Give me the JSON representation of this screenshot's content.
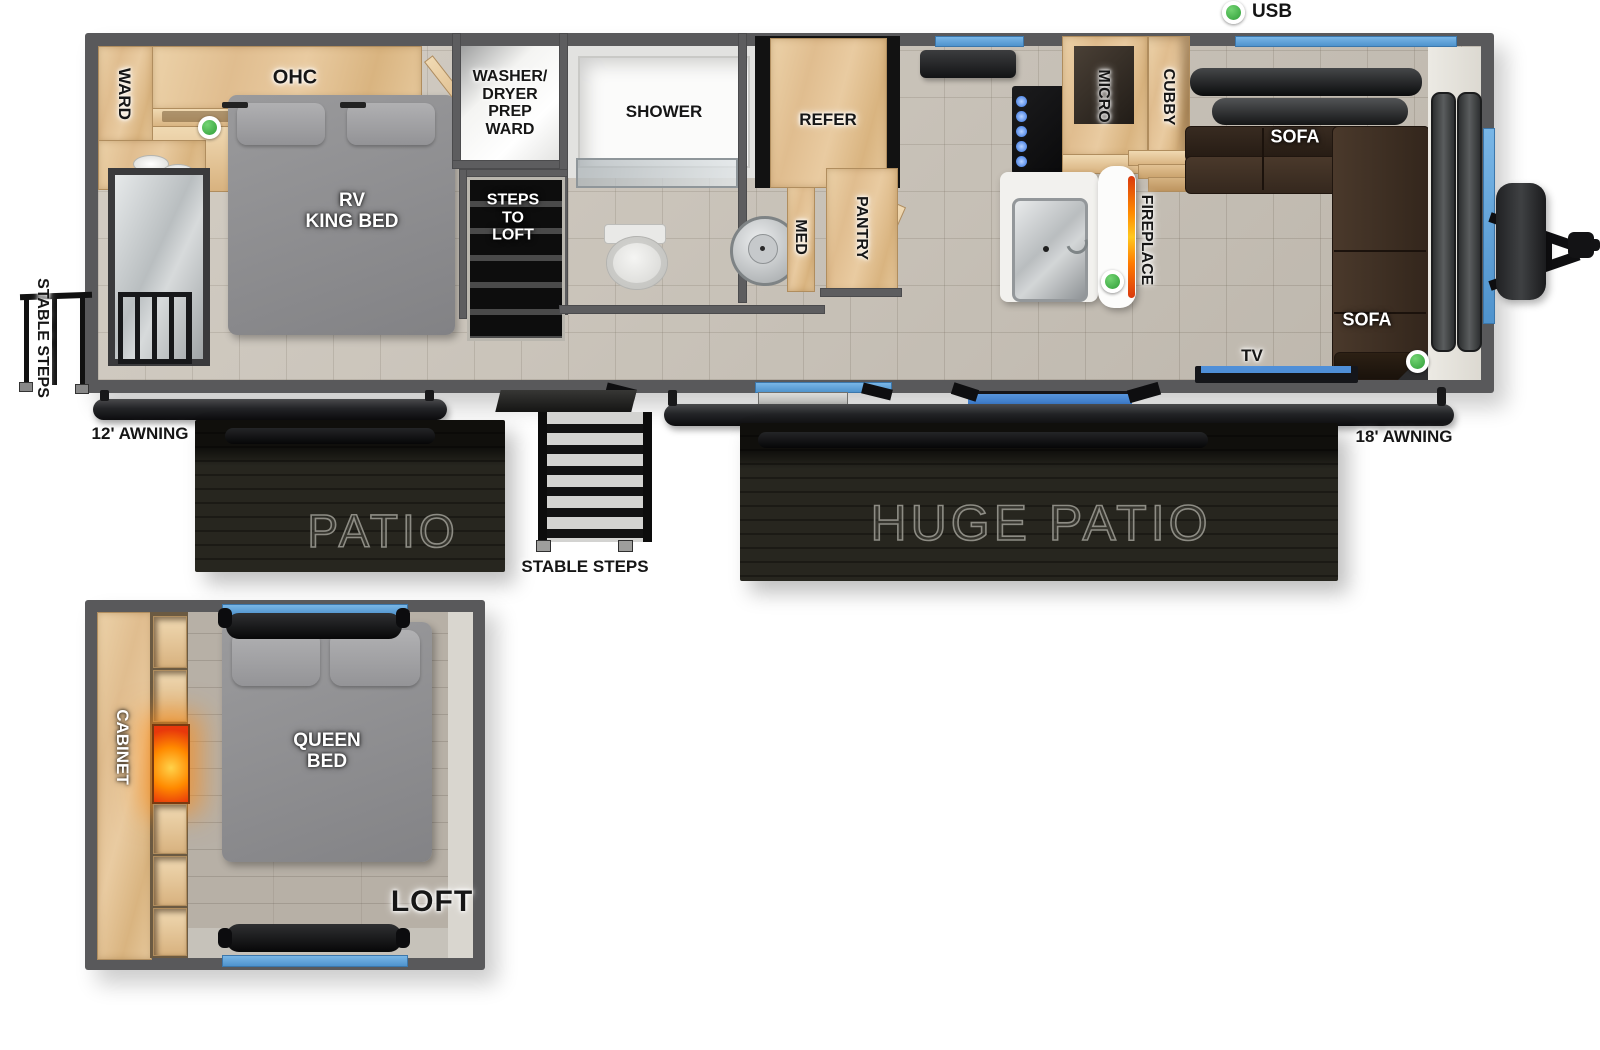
{
  "legend": {
    "usb": "USB"
  },
  "exterior": {
    "stable_steps_left": "STABLE STEPS",
    "awning_12": "12' AWNING",
    "patio": "PATIO",
    "stable_steps_center": "STABLE STEPS",
    "huge_patio": "HUGE PATIO",
    "awning_18": "18' AWNING"
  },
  "bedroom": {
    "ward": "WARD",
    "ohc": "OHC",
    "bed_line1": "RV",
    "bed_line2": "KING BED"
  },
  "utility": {
    "washer_line1": "WASHER/",
    "washer_line2": "DRYER",
    "washer_line3": "PREP",
    "washer_line4": "WARD",
    "steps_line1": "STEPS",
    "steps_line2": "TO",
    "steps_line3": "LOFT"
  },
  "bathroom": {
    "shower": "SHOWER",
    "med": "MED"
  },
  "kitchen": {
    "refer": "REFER",
    "pantry": "PANTRY",
    "micro": "MICRO",
    "cubby": "CUBBY",
    "fireplace": "FIREPLACE"
  },
  "living": {
    "sofa_top": "SOFA",
    "sofa_right": "SOFA",
    "tv": "TV"
  },
  "loft": {
    "cabinet": "CABINET",
    "bed_line1": "QUEEN",
    "bed_line2": "BED",
    "name": "LOFT"
  },
  "colors": {
    "accent_blue": "#5f9fd6",
    "indicator_green": "#3fae46",
    "wood": "#e2c193",
    "sofa_brown": "#40322a",
    "wall_gray": "#59595b",
    "patio_black": "#23221e"
  }
}
